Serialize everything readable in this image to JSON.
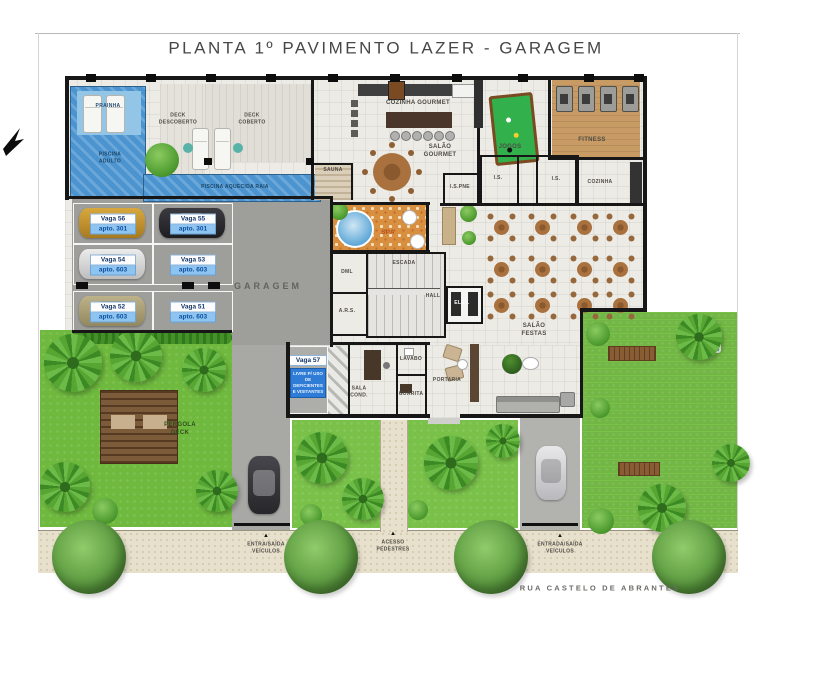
{
  "title": "PLANTA 1º PAVIMENTO LAZER - GARAGEM",
  "street": "RUA CASTELO DE ABRANTES",
  "rooms": {
    "prainha": "PRAINHA",
    "deck_descoberto": "DECK\nDESCOBERTO",
    "deck_coberto": "DECK\nCOBERTO",
    "piscina_adulto": "PISCINA\nADULTO",
    "piscina_raia": "PISCINA AQUECIDA RAIA",
    "sauna": "SAUNA",
    "cozinha_gourmet": "COZINHA GOURMET",
    "salao_gourmet": "SALÃO\nGOURMET",
    "jogos": "JOGOS",
    "fitness": "FITNESS",
    "is_pne": "I.S.PNE",
    "is_a": "I.S.",
    "is_b": "I.S.",
    "cozinha": "COZINHA",
    "spa": "SPA",
    "dml": "DML",
    "ars": "A.R.S.",
    "escada": "ESCADA",
    "hall": "HALL",
    "elev": "ELEV.",
    "garagem": "GARAGEM",
    "salao_festas": "SALÃO\nFESTAS",
    "sala_cond": "SALA\nCOND.",
    "lavabo": "LAVABO",
    "guarita": "GUARITA",
    "portaria": "PORTARIA",
    "pergola": "PÉRGOLA\nDECK"
  },
  "parking": {
    "spots": [
      {
        "vaga": "Vaga 56",
        "apto": "apto. 301"
      },
      {
        "vaga": "Vaga 55",
        "apto": "apto. 301"
      },
      {
        "vaga": "Vaga 54",
        "apto": "apto. 603"
      },
      {
        "vaga": "Vaga 53",
        "apto": "apto. 603"
      },
      {
        "vaga": "Vaga 52",
        "apto": "apto. 603"
      },
      {
        "vaga": "Vaga 51",
        "apto": "apto. 603"
      }
    ],
    "vaga57": {
      "vaga": "Vaga 57",
      "note": "LIVRE P/ USO\nDE DEFICIENTES\nE VISITANTES"
    }
  },
  "access": {
    "entrada_left": "ENTRA/SAÍDA\nVEÍCULOS",
    "pedestres": "ACESSO\nPEDESTRES",
    "entrada_right": "ENTRADA/SAÍDA\nVEÍCULOS"
  },
  "colors": {
    "water": "#4b94cf",
    "garage_floor": "#9e9e9b",
    "grass": "#79c149",
    "parking_tag_blue": "#8ec4f0",
    "vaga57_blue": "#2e7cd6",
    "spa_mosaic": "#d88f3f"
  }
}
